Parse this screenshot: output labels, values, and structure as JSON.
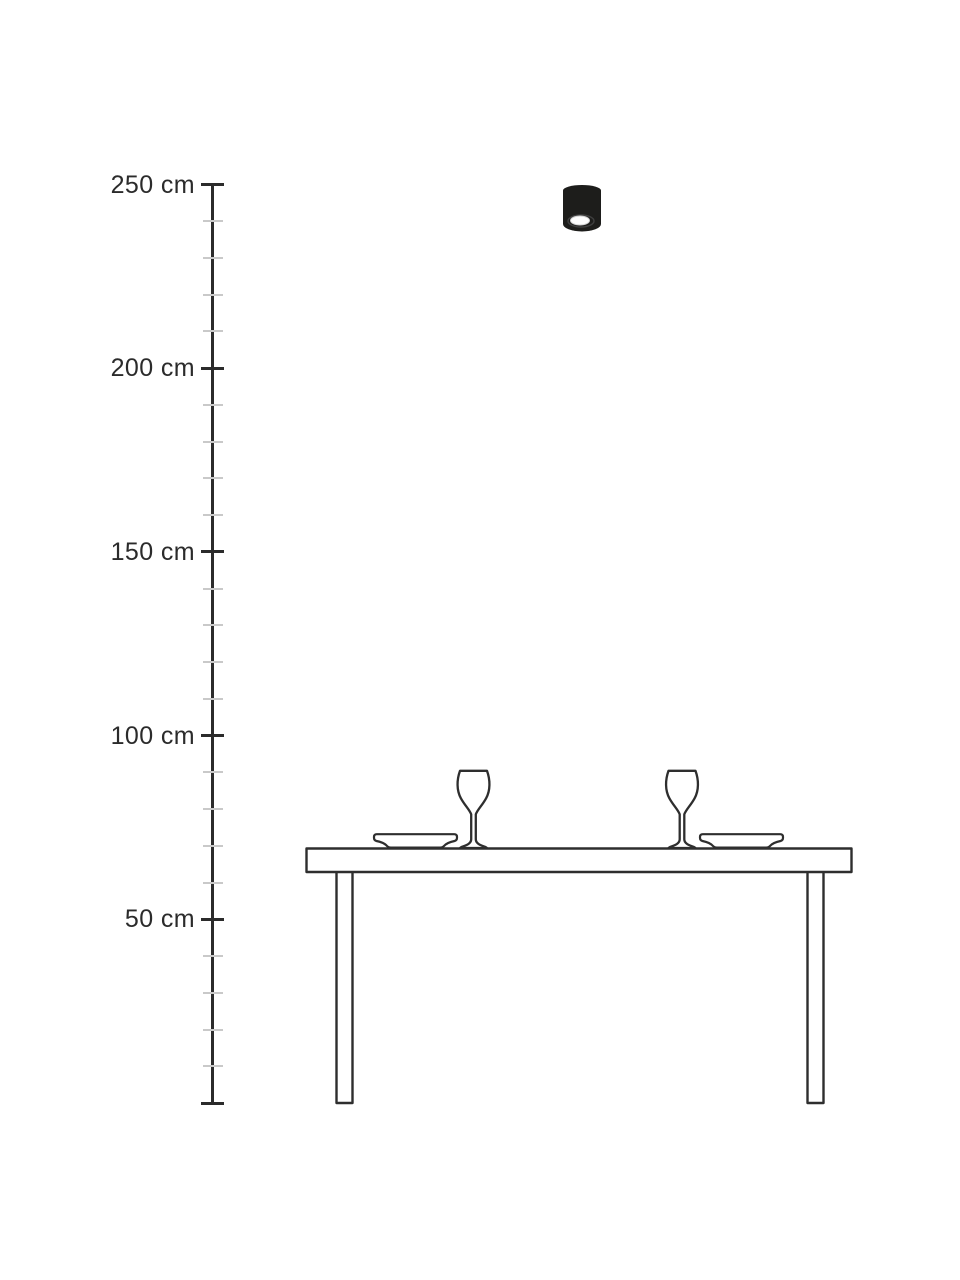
{
  "diagram": {
    "type": "product-height-dimension-diagram",
    "background": "#ffffff"
  },
  "scale": {
    "unit": "cm",
    "min_value": 0,
    "max_value": 250,
    "major_step_cm": 50,
    "minor_step_cm": 10,
    "labels": [
      "250 cm",
      "200 cm",
      "150 cm",
      "100 cm",
      "50 cm"
    ],
    "label_values_cm": [
      250,
      200,
      150,
      100,
      50
    ],
    "line_color": "#2b2b2b",
    "minor_tick_color": "#c9c9c9",
    "label_color": "#2b2b2b"
  },
  "illustration": {
    "scene_icons": [
      "ceiling-spotlight",
      "dining-table",
      "wine-glass",
      "wine-glass",
      "plate",
      "plate"
    ],
    "lamp_icon": "ceiling-spotlight",
    "lamp_shown_at_cm": 250,
    "lamp_color": "#1d1d1b",
    "lamp_lens_color": "#fdfdfd",
    "outline_color": "#2e2e2e",
    "fill_color": "#ffffff"
  }
}
